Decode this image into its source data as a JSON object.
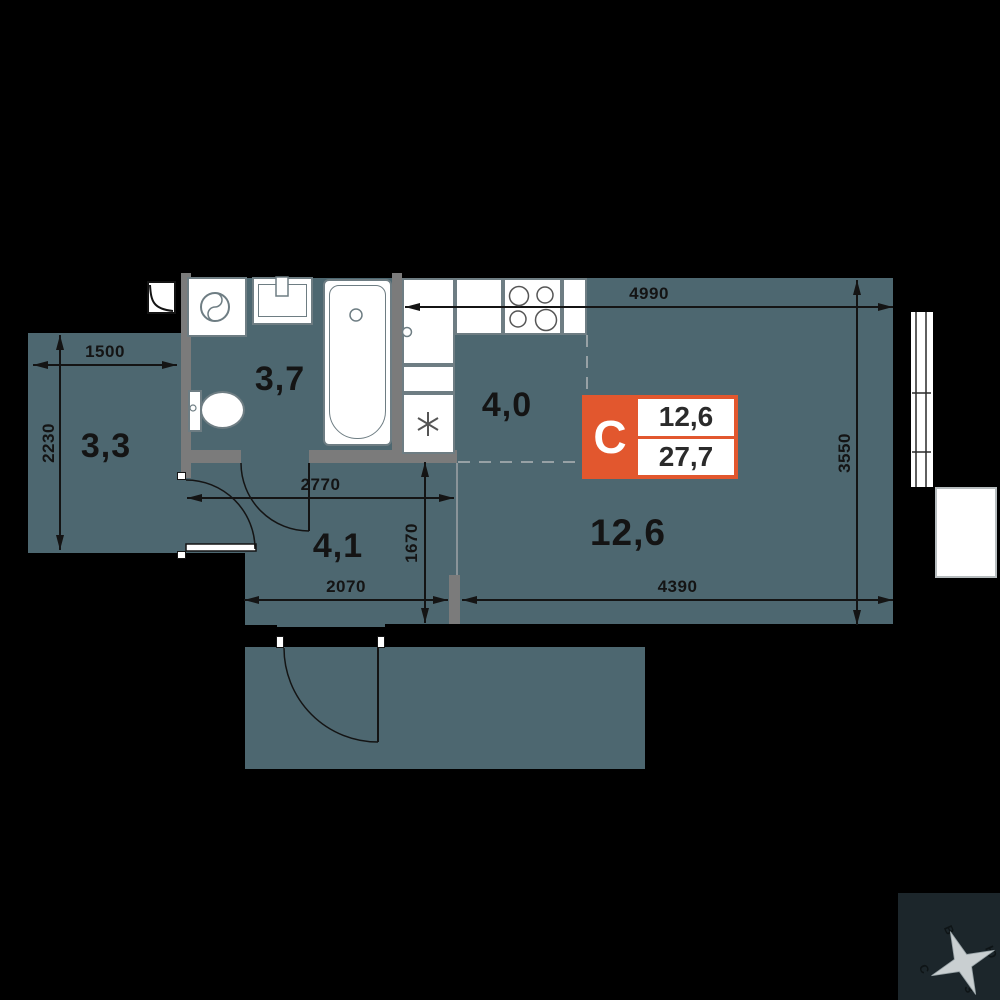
{
  "plan": {
    "rooms": [
      {
        "name": "loggia",
        "area": "3,3"
      },
      {
        "name": "bathroom",
        "area": "3,7"
      },
      {
        "name": "kitchen-zone",
        "area": "4,0"
      },
      {
        "name": "hall",
        "area": "4,1"
      },
      {
        "name": "living-room",
        "area": "12,6"
      }
    ],
    "dimensions": {
      "top": "4990",
      "right": "3550",
      "bottom_right": "4390",
      "bottom_left": "2070",
      "hall_width": "2770",
      "hall_height": "1670",
      "loggia_width": "1500",
      "loggia_height": "2230"
    }
  },
  "badge": {
    "type_letter": "С",
    "living_area": "12,6",
    "total_area": "27,7"
  },
  "compass": {
    "north": "С",
    "south": "Ю",
    "east": "В",
    "west": "З"
  },
  "colors": {
    "background": "#000000",
    "floor": "#4D6770",
    "wall": "#000000",
    "partition": "#7B7B7B",
    "accent_orange": "#E2572E",
    "fixture_white": "#FFFFFF",
    "outline_gray": "#6E7D83",
    "dimension_line": "#141414"
  },
  "icons": {
    "shaft-icon": "square with quarter curve",
    "washing-machine-icon": "circle with s-curve",
    "sink-icon": "basin with tap",
    "bathtub-icon": "rounded tub with drain",
    "toilet-icon": "tank and bowl",
    "stove-icon": "four burner circles",
    "appliance-icon": "six-point asterisk",
    "window-icon": "double glazing lines",
    "door-swing-icon": "quarter-circle arc",
    "compass-rose-icon": "four-point star"
  }
}
